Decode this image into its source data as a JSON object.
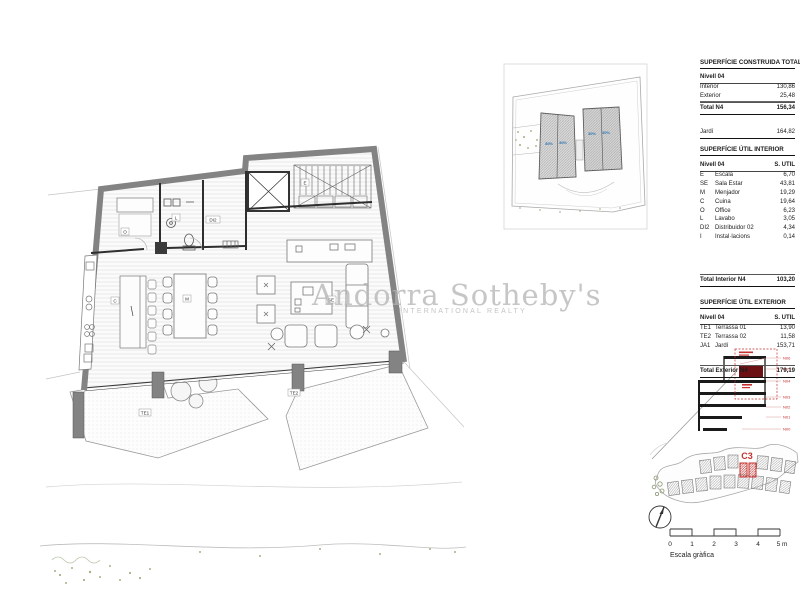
{
  "watermark": {
    "brand": "Andorra Sotheby's",
    "subtitle": "INTERNATIONAL REALTY"
  },
  "tables": {
    "construida": {
      "title": "SUPERFÍCIE CONSTRUIDA TOTAL",
      "level": "Nivell 04",
      "rows": [
        {
          "label": "Interior",
          "value": "130,86"
        },
        {
          "label": "Exterior",
          "value": "25,48"
        }
      ],
      "total": {
        "label": "Total N4",
        "value": "156,34"
      },
      "jardi": {
        "label": "Jardí",
        "value": "164,82"
      }
    },
    "util_interior": {
      "title": "SUPERFÍCIE ÚTIL INTERIOR",
      "level": "Nivell 04",
      "col": "S. UTIL",
      "rows": [
        {
          "code": "E",
          "label": "Escala",
          "value": "6,70"
        },
        {
          "code": "SE",
          "label": "Sala Estar",
          "value": "43,81"
        },
        {
          "code": "M",
          "label": "Menjador",
          "value": "19,29"
        },
        {
          "code": "C",
          "label": "Cuina",
          "value": "19,64"
        },
        {
          "code": "O",
          "label": "Office",
          "value": "6,23"
        },
        {
          "code": "L",
          "label": "Lavabo",
          "value": "3,05"
        },
        {
          "code": "DI2",
          "label": "Distribuidor 02",
          "value": "4,34"
        },
        {
          "code": "I",
          "label": "Instal·lacions",
          "value": "0,14"
        }
      ],
      "total": {
        "label": "Total Interior N4",
        "value": "103,20"
      }
    },
    "util_exterior": {
      "title": "SUPERFÍCIE ÚTIL EXTERIOR",
      "level": "Nivell 04",
      "col": "S. UTIL",
      "rows": [
        {
          "code": "TE1",
          "label": "Terrassa 01",
          "value": "13,90"
        },
        {
          "code": "TE2",
          "label": "Terrassa 02",
          "value": "11,58"
        },
        {
          "code": "JA1",
          "label": "Jardí",
          "value": "153,71"
        }
      ],
      "total": {
        "label": "Total Exterior N4",
        "value": "179,19"
      }
    }
  },
  "plan": {
    "labels": {
      "escala": "E",
      "office": "O",
      "lavabo": "L",
      "distribuidor": "DI2",
      "cuina": "C",
      "menjador": "M",
      "sala_estar": "SE",
      "terrassa1": "TE1",
      "terrassa2": "TE2"
    }
  },
  "site_plan": {
    "roof_labels": [
      "30%",
      "30%",
      "30%",
      "30%"
    ]
  },
  "section": {
    "levels": [
      "N06",
      "N05",
      "N04",
      "N03",
      "N02",
      "N01",
      "N00"
    ]
  },
  "location_map": {
    "unit_label": "C3"
  },
  "scale_bar": {
    "ticks": [
      "0",
      "1",
      "2",
      "3",
      "4",
      "5 m"
    ],
    "caption": "Escala gràfica"
  },
  "colors": {
    "accent_red": "#c4322f",
    "dark_red": "#6b1013",
    "roof_blue": "#2e77b5",
    "wall_gray": "#838383",
    "vegetation_green": "#7f9a5f",
    "watermark_gray": "#b3b3b3"
  }
}
